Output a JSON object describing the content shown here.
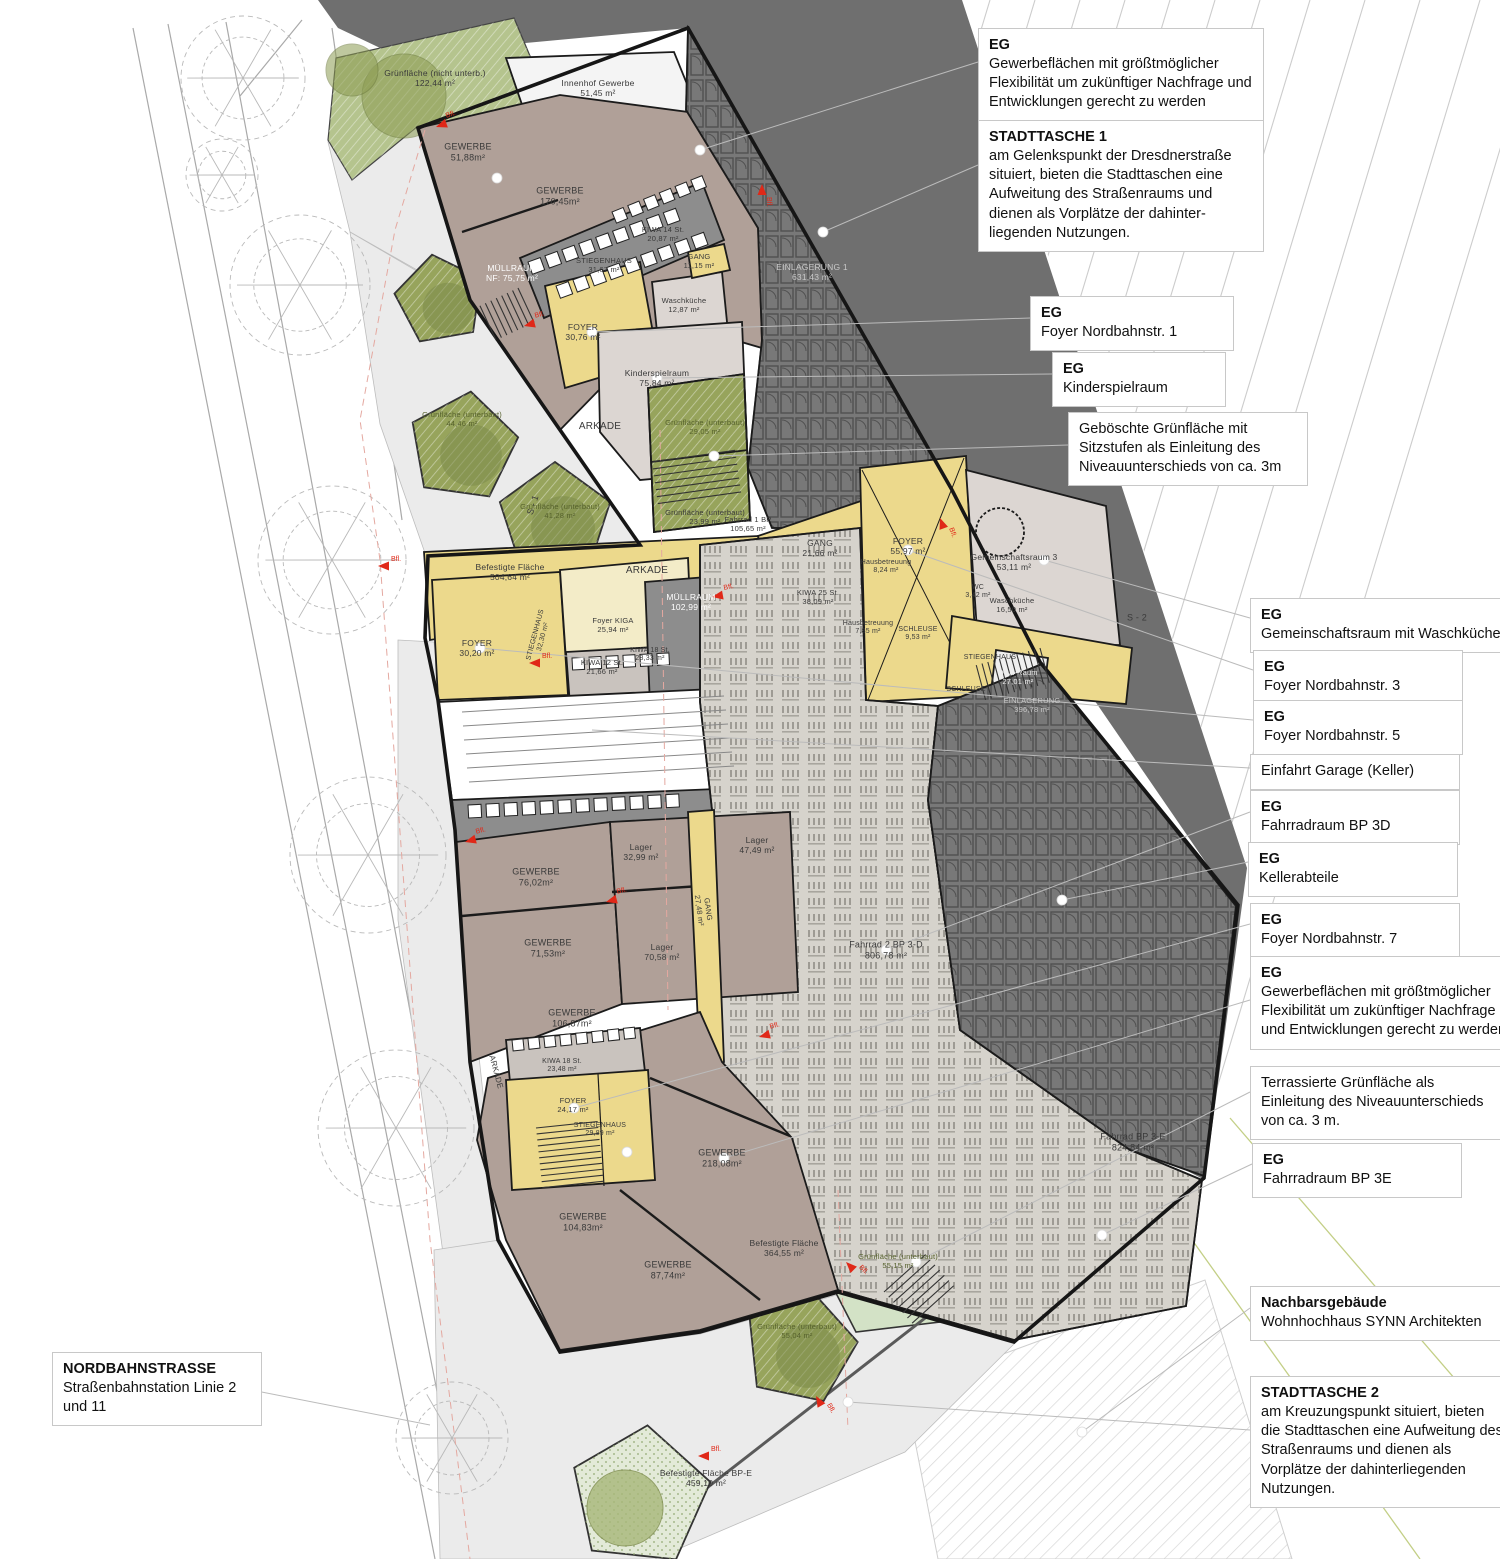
{
  "colors": {
    "circulation_yellow": "#ecd98c",
    "circulation_pale": "#f3ecc8",
    "commercial_mauve": "#b0a098",
    "room_pale": "#dcd6d2",
    "bike_hall_gray": "#d6d3cc",
    "storage_dark": "#787878",
    "embankment": "#6f6f6f",
    "plaza": "#ebebeb",
    "green_olive": "#97a45c",
    "green_pale": "#d3e2c6",
    "wall": "#1b1b1b",
    "marker_red": "#e02818"
  },
  "plan": {
    "marker_label": "Bfl.",
    "labels": [
      {
        "x": 435,
        "y": 78,
        "t": [
          "Grünfläche (nicht unterb.)",
          "122,44 m²"
        ]
      },
      {
        "x": 598,
        "y": 88,
        "t": [
          "Innenhof Gewerbe",
          "51,45 m²"
        ]
      },
      {
        "x": 468,
        "y": 152,
        "s": 9,
        "t": [
          "GEWERBE",
          "51,88m²"
        ]
      },
      {
        "x": 560,
        "y": 196,
        "s": 9,
        "t": [
          "GEWERBE",
          "170,45m²"
        ]
      },
      {
        "x": 663,
        "y": 235,
        "s": 7.5,
        "t": [
          "KIWA 14 St.",
          "20,87 m²"
        ]
      },
      {
        "x": 512,
        "y": 273,
        "c": "#ffffff",
        "t": [
          "MÜLLRAUM",
          "NF: 75,75 m²"
        ]
      },
      {
        "x": 604,
        "y": 266,
        "s": 7.5,
        "t": [
          "STIEGENHAUS",
          "31,67 m²"
        ]
      },
      {
        "x": 699,
        "y": 262,
        "s": 7.5,
        "t": [
          "GANG",
          "11,15 m²"
        ]
      },
      {
        "x": 684,
        "y": 306,
        "s": 7.5,
        "t": [
          "Waschküche",
          "12,87 m²"
        ]
      },
      {
        "x": 583,
        "y": 332,
        "t": [
          "FOYER",
          "30,76 m²"
        ]
      },
      {
        "x": 657,
        "y": 378,
        "t": [
          "Kinderspielraum",
          "75,84 m²"
        ]
      },
      {
        "x": 812,
        "y": 272,
        "c": "#c9c9c9",
        "t": [
          "EINLAGERUNG 1",
          "631,43 m²"
        ]
      },
      {
        "x": 600,
        "y": 427,
        "s": 10,
        "t": [
          "ARKADE"
        ]
      },
      {
        "x": 705,
        "y": 428,
        "s": 7.5,
        "c": "#55602c",
        "t": [
          "Grünfläche (unterbaut)",
          "29,05 m²"
        ]
      },
      {
        "x": 462,
        "y": 420,
        "s": 7.5,
        "c": "#55602c",
        "t": [
          "Grünfläche (unterbaut)",
          "44,46 m²"
        ]
      },
      {
        "x": 560,
        "y": 512,
        "s": 7.5,
        "c": "#55602c",
        "t": [
          "Grünfläche (unterbaut)",
          "41,28 m²"
        ]
      },
      {
        "x": 705,
        "y": 518,
        "s": 7.5,
        "t": [
          "Grünfläche (unterbaut)",
          "23,99 m²"
        ]
      },
      {
        "x": 510,
        "y": 572,
        "t": [
          "Befestigte Fläche",
          "504,64 m²"
        ]
      },
      {
        "x": 748,
        "y": 525,
        "s": 7.5,
        "t": [
          "Fahrrad 1 BP",
          "105,65 m²"
        ]
      },
      {
        "x": 647,
        "y": 571,
        "s": 10,
        "t": [
          "ARKADE"
        ]
      },
      {
        "x": 820,
        "y": 548,
        "t": [
          "GANG",
          "21,66 m²"
        ]
      },
      {
        "x": 908,
        "y": 546,
        "t": [
          "FOYER",
          "55,97 m²"
        ]
      },
      {
        "x": 1014,
        "y": 562,
        "t": [
          "Gemeinschaftsraum 3",
          "53,11 m²"
        ]
      },
      {
        "x": 886,
        "y": 567,
        "s": 7,
        "t": [
          "Hausbetreuung",
          "8,24 m²"
        ]
      },
      {
        "x": 818,
        "y": 598,
        "s": 7.5,
        "t": [
          "KIWA 25 St.",
          "38,09 m²"
        ]
      },
      {
        "x": 868,
        "y": 628,
        "s": 7,
        "t": [
          "Hausbetreuung",
          "7,85 m²"
        ]
      },
      {
        "x": 918,
        "y": 634,
        "s": 7,
        "t": [
          "SCHLEUSE",
          "9,53 m²"
        ]
      },
      {
        "x": 978,
        "y": 592,
        "s": 7,
        "t": [
          "WC",
          "3,42 m²"
        ]
      },
      {
        "x": 1012,
        "y": 606,
        "s": 7.5,
        "t": [
          "Waschküche",
          "16,50 m²"
        ]
      },
      {
        "x": 691,
        "y": 602,
        "c": "#ffffff",
        "t": [
          "MÜLLRAUM",
          "102,99 m²"
        ]
      },
      {
        "x": 613,
        "y": 626,
        "s": 7.5,
        "t": [
          "Foyer KIGA",
          "25,94 m²"
        ]
      },
      {
        "x": 650,
        "y": 655,
        "s": 7,
        "t": [
          "KIWA 18 St.",
          "28,33 m²"
        ]
      },
      {
        "x": 477,
        "y": 648,
        "t": [
          "FOYER",
          "30,20 m²"
        ]
      },
      {
        "x": 540,
        "y": 636,
        "s": 7,
        "r": -75,
        "t": [
          "STIEGENHAUS",
          "32,30 m²"
        ]
      },
      {
        "x": 602,
        "y": 668,
        "s": 7.5,
        "t": [
          "KIWA 12 St.",
          "21,66 m²"
        ]
      },
      {
        "x": 990,
        "y": 658,
        "s": 7,
        "t": [
          "STIEGENHAUS"
        ]
      },
      {
        "x": 966,
        "y": 690,
        "s": 7,
        "t": [
          "SCHLEUSE"
        ]
      },
      {
        "x": 1018,
        "y": 678,
        "s": 7.5,
        "c": "#ededed",
        "t": [
          "DBA-Raum",
          "27,01 m²"
        ]
      },
      {
        "x": 1032,
        "y": 706,
        "s": 7.5,
        "c": "#c9c9c9",
        "t": [
          "EINLAGERUNG",
          "396,78 m²"
        ]
      },
      {
        "x": 886,
        "y": 950,
        "s": 9,
        "t": [
          "Fahrrad 2 BP 3-D",
          "806,78 m²"
        ]
      },
      {
        "x": 1133,
        "y": 1142,
        "s": 9,
        "t": [
          "Fahrrad BP 3-E",
          "824,84 m²"
        ]
      },
      {
        "x": 641,
        "y": 852,
        "t": [
          "Lager",
          "32,99 m²"
        ]
      },
      {
        "x": 757,
        "y": 845,
        "t": [
          "Lager",
          "47,49 m²"
        ]
      },
      {
        "x": 662,
        "y": 952,
        "t": [
          "Lager",
          "70,58 m²"
        ]
      },
      {
        "x": 703,
        "y": 910,
        "s": 7.5,
        "r": 82,
        "t": [
          "GANG",
          "27,48 m²"
        ]
      },
      {
        "x": 536,
        "y": 877,
        "s": 9,
        "t": [
          "GEWERBE",
          "76,02m²"
        ]
      },
      {
        "x": 548,
        "y": 948,
        "s": 9,
        "t": [
          "GEWERBE",
          "71,53m²"
        ]
      },
      {
        "x": 572,
        "y": 1018,
        "s": 9,
        "t": [
          "GEWERBE",
          "106,87m²"
        ]
      },
      {
        "x": 562,
        "y": 1066,
        "s": 7,
        "t": [
          "KIWA 18 St.",
          "23,48 m²"
        ]
      },
      {
        "x": 573,
        "y": 1106,
        "s": 7.5,
        "t": [
          "FOYER",
          "24,17 m²"
        ]
      },
      {
        "x": 600,
        "y": 1130,
        "s": 7,
        "t": [
          "STIEGENHAUS",
          "29,89 m²"
        ]
      },
      {
        "x": 496,
        "y": 1072,
        "s": 8,
        "r": 75,
        "t": [
          "ARKADE"
        ]
      },
      {
        "x": 722,
        "y": 1158,
        "s": 9,
        "t": [
          "GEWERBE",
          "218,08m²"
        ]
      },
      {
        "x": 583,
        "y": 1222,
        "s": 9,
        "t": [
          "GEWERBE",
          "104,83m²"
        ]
      },
      {
        "x": 668,
        "y": 1270,
        "s": 9,
        "t": [
          "GEWERBE",
          "87,74m²"
        ]
      },
      {
        "x": 784,
        "y": 1248,
        "t": [
          "Befestigte Fläche",
          "364,55 m²"
        ]
      },
      {
        "x": 898,
        "y": 1262,
        "s": 7.5,
        "c": "#55602c",
        "t": [
          "Grünfläche (unterbaut)",
          "55,15 m²"
        ]
      },
      {
        "x": 797,
        "y": 1332,
        "s": 7.5,
        "c": "#55602c",
        "t": [
          "Grünfläche (unterbaut)",
          "55,04 m²"
        ]
      },
      {
        "x": 706,
        "y": 1478,
        "t": [
          "Befestigte Fläche BP-E",
          "459,10 m²"
        ]
      },
      {
        "x": 533,
        "y": 505,
        "s": 9,
        "r": -72,
        "t": [
          "S - 1"
        ]
      },
      {
        "x": 1137,
        "y": 618,
        "s": 9,
        "t": [
          "S - 2"
        ]
      }
    ]
  },
  "annotations": [
    {
      "name": "note-gewerbe-north",
      "x": 978,
      "y": 28,
      "w": 264,
      "title": "EG",
      "body": "Gewerbeflächen mit größtmöglicher Flexibilität um zukünftiger Nachfrage und Entwicklungen gerecht zu werden"
    },
    {
      "name": "note-stadttasche-1",
      "x": 978,
      "y": 120,
      "w": 264,
      "title": "STADTTASCHE 1",
      "body": "am Gelenkspunkt der Dresdnerstraße situiert, bieten die Stadttaschen eine Aufweitung des Straßenraums und dienen als Vorplätze der dahinter- liegenden Nutzungen."
    },
    {
      "name": "note-foyer-1",
      "x": 1030,
      "y": 296,
      "w": 182,
      "title": "EG",
      "body": "Foyer Nordbahnstr. 1"
    },
    {
      "name": "note-kinderspielraum",
      "x": 1052,
      "y": 352,
      "w": 152,
      "title": "EG",
      "body": "Kinderspielraum"
    },
    {
      "name": "note-geboeschte-gruenflaeche",
      "x": 1068,
      "y": 412,
      "w": 218,
      "title": "",
      "body": "Geböschte Grünfläche mit Sitzstufen als Einleitung des Niveauunterschieds von ca. 3m"
    },
    {
      "name": "note-gemeinschaftsraum",
      "x": 1250,
      "y": 598,
      "w": 246,
      "title": "EG",
      "body": "Gemeinschaftsraum mit Waschküche"
    },
    {
      "name": "note-foyer-3",
      "x": 1253,
      "y": 650,
      "w": 188,
      "title": "EG",
      "body": "Foyer Nordbahnstr. 3"
    },
    {
      "name": "note-foyer-5",
      "x": 1253,
      "y": 700,
      "w": 188,
      "title": "EG",
      "body": "Foyer Nordbahnstr. 5"
    },
    {
      "name": "note-einfahrt-garage",
      "x": 1250,
      "y": 754,
      "w": 188,
      "title": "",
      "body": "Einfahrt Garage (Keller)"
    },
    {
      "name": "note-fahrradraum-3d",
      "x": 1250,
      "y": 790,
      "w": 188,
      "title": "EG",
      "body": "Fahrradraum BP 3D"
    },
    {
      "name": "note-kellerabteile",
      "x": 1248,
      "y": 842,
      "w": 188,
      "title": "EG",
      "body": "Kellerabteile"
    },
    {
      "name": "note-foyer-7",
      "x": 1250,
      "y": 903,
      "w": 188,
      "title": "EG",
      "body": "Foyer Nordbahnstr. 7"
    },
    {
      "name": "note-gewerbe-south",
      "x": 1250,
      "y": 956,
      "w": 246,
      "title": "EG",
      "body": "Gewerbeflächen mit größtmöglicher Flexibilität um zukünftiger Nachfrage und Entwicklungen gerecht zu werden"
    },
    {
      "name": "note-terrassierte-gruenflaeche",
      "x": 1250,
      "y": 1066,
      "w": 234,
      "title": "",
      "body": "Terrassierte Grünfläche als Einleitung des Niveauunterschieds von ca. 3 m."
    },
    {
      "name": "note-fahrradraum-3e",
      "x": 1252,
      "y": 1143,
      "w": 188,
      "title": "EG",
      "body": "Fahrradraum BP 3E"
    },
    {
      "name": "note-nachbarsgebaeude",
      "x": 1250,
      "y": 1286,
      "w": 246,
      "title": "Nachbarsgebäude",
      "body": "Wohnhochhaus SYNN Architekten"
    },
    {
      "name": "note-stadttasche-2",
      "x": 1250,
      "y": 1376,
      "w": 246,
      "title": "STADTTASCHE 2",
      "body": "am Kreuzungspunkt situiert, bieten die Stadttaschen eine Aufweitung des Straßenraums und dienen als Vorplätze der dahinterliegenden Nutzungen."
    },
    {
      "name": "note-nordbahnstrasse",
      "x": 52,
      "y": 1352,
      "w": 188,
      "title": "NORDBAHNSTRASSE",
      "body": "Straßenbahnstation Linie 2 und 11"
    }
  ]
}
